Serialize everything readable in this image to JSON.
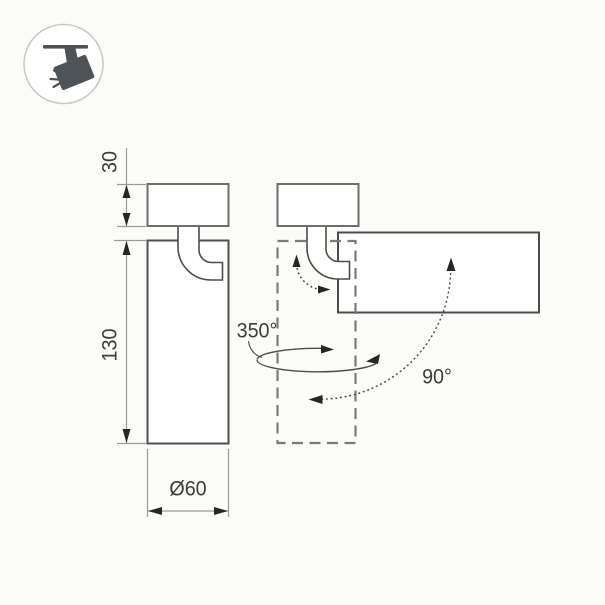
{
  "drawing": {
    "dim_mount_height": "30",
    "dim_body_height": "130",
    "dim_diameter": "Ø60",
    "angle_rotation": "350°",
    "angle_tilt": "90°"
  },
  "colors": {
    "line": "#4c4c4c",
    "body_line": "#4f4f4f",
    "mount_line": "#6e6e6e",
    "dash_line": "#7a7a7a",
    "dim_line": "#9b9b9b",
    "arrow": "#262626",
    "text": "#3c3c3c",
    "icon": "#4d5357",
    "icon_ring": "#cacaca",
    "background": "#fbfbf8",
    "fill": "#ffffff"
  }
}
